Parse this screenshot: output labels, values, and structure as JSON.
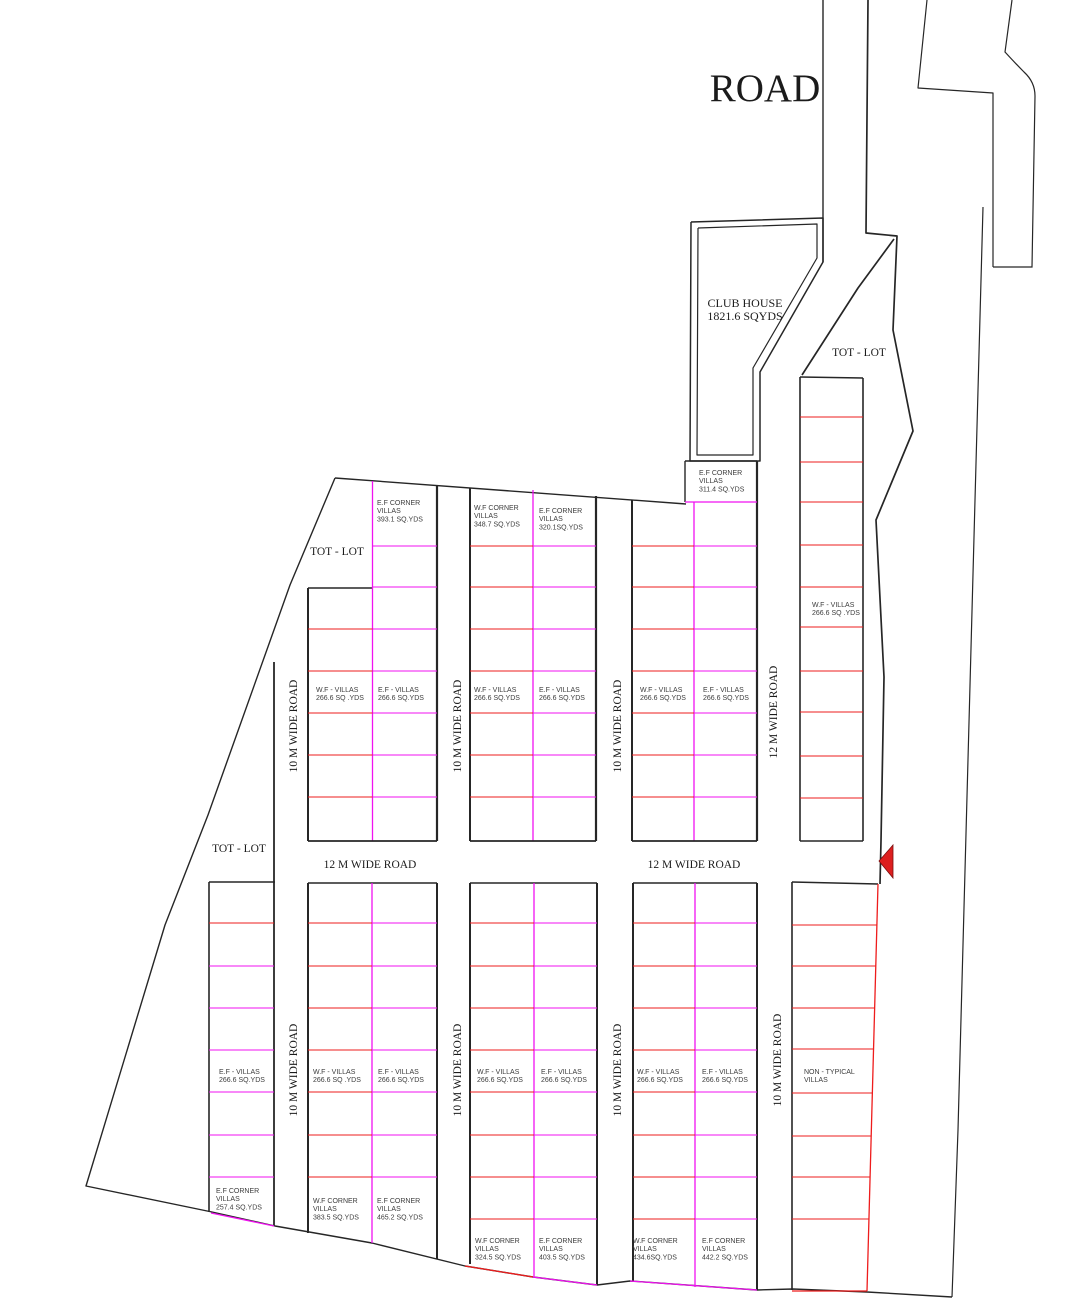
{
  "titles": {
    "road": "ROAD"
  },
  "club_house": {
    "lines": [
      "CLUB HOUSE",
      "1821.6 SQYDS"
    ]
  },
  "tot_lot": "TOT - LOT",
  "roads": {
    "r10": "10 M WIDE ROAD",
    "r12": "12 M WIDE ROAD"
  },
  "villas": {
    "wf_266_sp": [
      "W.F - VILLAS",
      "266.6 SQ .YDS"
    ],
    "wf_266": [
      "W.F - VILLAS",
      "266.6 SQ.YDS"
    ],
    "ef_266": [
      "E.F - VILLAS",
      "266.6 SQ.YDS"
    ],
    "non_typical": [
      "NON - TYPICAL",
      "VILLAS"
    ],
    "ef_corner_393": [
      "E.F CORNER",
      "VILLAS",
      "393.1 SQ.YDS"
    ],
    "wf_corner_348": [
      "W.F CORNER",
      "VILLAS",
      "348.7 SQ.YDS"
    ],
    "ef_corner_320": [
      "E.F CORNER",
      "VILLAS",
      "320.1SQ.YDS"
    ],
    "ef_corner_311": [
      "E.F CORNER",
      "VILLAS",
      "311.4 SQ.YDS"
    ],
    "ef_corner_257": [
      "E.F CORNER",
      "VILLAS",
      "257.4 SQ.YDS"
    ],
    "wf_corner_383": [
      "W.F CORNER",
      "VILLAS",
      "383.5 SQ.YDS"
    ],
    "ef_corner_465": [
      "E.F CORNER",
      "VILLAS",
      "465.2 SQ.YDS"
    ],
    "wf_corner_324": [
      "W.F CORNER",
      "VILLAS",
      "324.5 SQ.YDS"
    ],
    "ef_corner_403": [
      "E.F CORNER",
      "VILLAS",
      "403.5 SQ.YDS"
    ],
    "wf_corner_434": [
      "W.F CORNER",
      "VILLAS",
      "434.6SQ.YDS"
    ],
    "ef_corner_442": [
      "E.F CORNER",
      "VILLAS",
      "442.2 SQ.YDS"
    ]
  },
  "colors": {
    "line_black": "#262626",
    "line_red": "#ee1c1c",
    "line_magenta": "#f012f0",
    "arrow_red": "#dd1f1f",
    "text_dark": "#1b1b1b",
    "text_plot": "#3c3c3c"
  }
}
